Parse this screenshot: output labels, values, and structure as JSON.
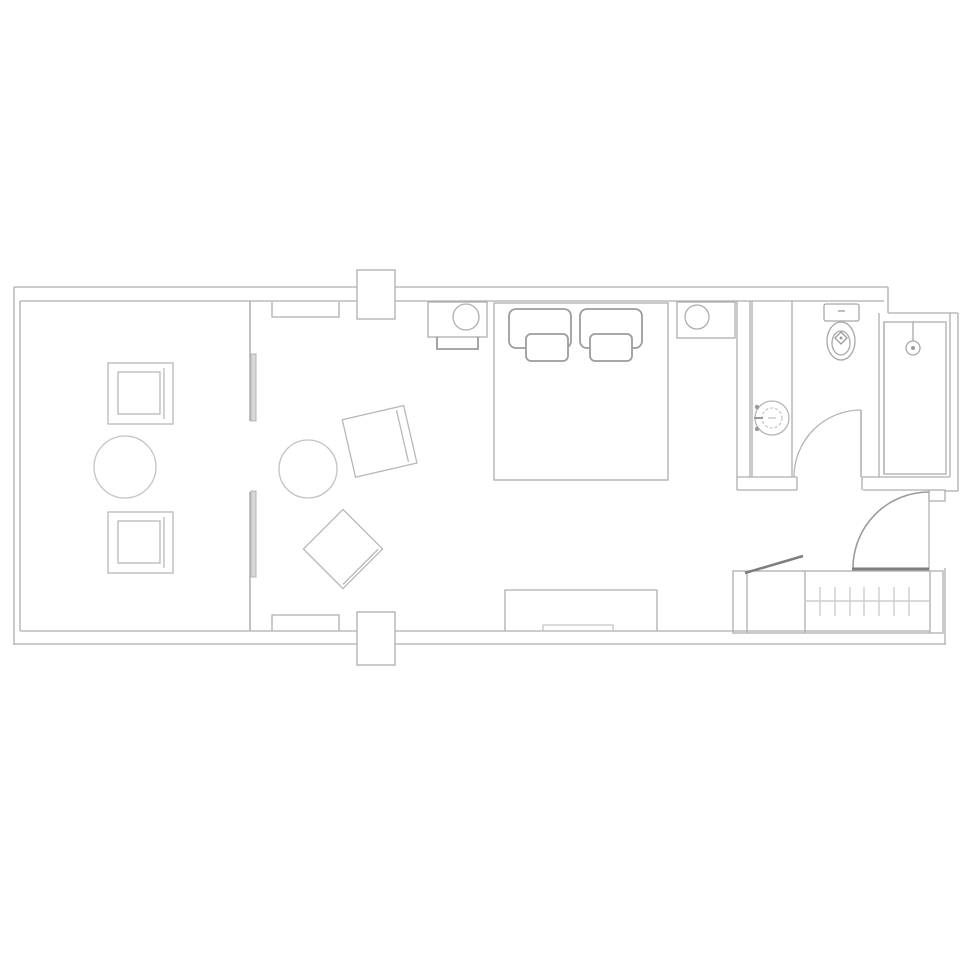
{
  "meta": {
    "title": "Hotel guest room floor plan",
    "description": "Monochrome line-drawing floor plan of a long guest room: balcony with two armchairs and round table, living area with armchair, ottoman and side table, bedroom with desk, king bed, nightstand and TV console, bathroom with vanity sink, toilet and shower, entry door and wardrobe with hangers and luggage rack."
  },
  "canvas": {
    "width": 975,
    "height": 975,
    "background": "#ffffff"
  },
  "palette": {
    "wall": "#aeaeae",
    "light": "#c3c3c3",
    "mid": "#9b9b9b",
    "dark": "#7e7e7e",
    "panel_fill": "#d8d8d8",
    "white": "#ffffff"
  },
  "rooms": [
    "balcony",
    "living-area",
    "bedroom",
    "bathroom",
    "entry",
    "wardrobe"
  ],
  "elements": [
    {
      "name": "outer-walls",
      "interactable": false,
      "shapes": [
        {
          "type": "line",
          "x1": 14,
          "y1": 287,
          "x2": 888,
          "y2": 287
        },
        {
          "type": "line",
          "x1": 20,
          "y1": 301,
          "x2": 884,
          "y2": 301
        },
        {
          "type": "line",
          "x1": 14,
          "y1": 287,
          "x2": 14,
          "y2": 645
        },
        {
          "type": "line",
          "x1": 20,
          "y1": 301,
          "x2": 20,
          "y2": 631
        },
        {
          "type": "line",
          "x1": 20,
          "y1": 631,
          "x2": 930,
          "y2": 631
        },
        {
          "type": "line",
          "x1": 14,
          "y1": 644,
          "x2": 946,
          "y2": 644
        },
        {
          "type": "line",
          "x1": 888,
          "y1": 287,
          "x2": 888,
          "y2": 313
        },
        {
          "type": "line",
          "x1": 888,
          "y1": 313,
          "x2": 958,
          "y2": 313
        },
        {
          "type": "line",
          "x1": 958,
          "y1": 313,
          "x2": 958,
          "y2": 491
        },
        {
          "type": "line",
          "x1": 958,
          "y1": 491,
          "x2": 945,
          "y2": 491
        },
        {
          "type": "rect",
          "x": 929,
          "y": 490,
          "w": 16,
          "h": 11
        },
        {
          "type": "line",
          "x1": 945,
          "y1": 568,
          "x2": 945,
          "y2": 644
        }
      ]
    },
    {
      "name": "balcony-divider-wall",
      "interactable": false,
      "sw": 1.5,
      "shapes": [
        {
          "type": "line",
          "x1": 250,
          "y1": 301,
          "x2": 250,
          "y2": 421
        },
        {
          "type": "line",
          "x1": 250,
          "y1": 492,
          "x2": 250,
          "y2": 631
        }
      ]
    },
    {
      "name": "sliding-door-panels",
      "interactable": false,
      "stroke": "#b5b5b5",
      "sw": 1,
      "shapes": [
        {
          "type": "rect",
          "x": 251,
          "y": 354,
          "w": 5,
          "h": 67,
          "fill": "#d8d8d8"
        },
        {
          "type": "rect",
          "x": 251,
          "y": 491,
          "w": 5,
          "h": 86,
          "fill": "#d8d8d8"
        }
      ]
    },
    {
      "name": "wall-pier-top",
      "interactable": false,
      "shapes": [
        {
          "type": "rect",
          "x": 357,
          "y": 270,
          "w": 38,
          "h": 49,
          "fill": "#ffffff"
        }
      ]
    },
    {
      "name": "wall-pier-bottom",
      "interactable": false,
      "shapes": [
        {
          "type": "rect",
          "x": 357,
          "y": 612,
          "w": 38,
          "h": 53,
          "fill": "#ffffff"
        }
      ]
    },
    {
      "name": "curtain-box-top",
      "interactable": false,
      "shapes": [
        {
          "type": "path",
          "d": "M272,302 L272,317 L339,317 L339,302"
        }
      ]
    },
    {
      "name": "curtain-box-bottom",
      "interactable": false,
      "shapes": [
        {
          "type": "path",
          "d": "M272,631 L272,615 L339,615 L339,631"
        }
      ]
    },
    {
      "name": "balcony-armchair-top",
      "interactable": false,
      "stroke": "#b8b8b8",
      "shapes": [
        {
          "type": "rect",
          "x": 108,
          "y": 363,
          "w": 65,
          "h": 61
        },
        {
          "type": "rect",
          "x": 118,
          "y": 372,
          "w": 42,
          "h": 42
        },
        {
          "type": "line",
          "x1": 164,
          "y1": 368,
          "x2": 164,
          "y2": 419
        }
      ]
    },
    {
      "name": "balcony-table",
      "interactable": false,
      "stroke": "#c3c3c3",
      "shapes": [
        {
          "type": "circle",
          "cx": 125,
          "cy": 467,
          "r": 31
        }
      ]
    },
    {
      "name": "balcony-armchair-bottom",
      "interactable": false,
      "stroke": "#b8b8b8",
      "shapes": [
        {
          "type": "rect",
          "x": 108,
          "y": 512,
          "w": 65,
          "h": 61
        },
        {
          "type": "rect",
          "x": 118,
          "y": 521,
          "w": 42,
          "h": 42
        },
        {
          "type": "line",
          "x1": 164,
          "y1": 517,
          "x2": 164,
          "y2": 568
        }
      ]
    },
    {
      "name": "living-side-table",
      "interactable": false,
      "stroke": "#c3c3c3",
      "shapes": [
        {
          "type": "circle",
          "cx": 308,
          "cy": 469,
          "r": 29
        }
      ]
    },
    {
      "name": "living-armchair",
      "interactable": false,
      "stroke": "#b8b8b8",
      "transform": "rotate(-13 379 441)",
      "shapes": [
        {
          "type": "rect",
          "x": 348,
          "y": 412,
          "w": 63,
          "h": 59
        },
        {
          "type": "line",
          "x1": 403,
          "y1": 415,
          "x2": 403,
          "y2": 468
        }
      ]
    },
    {
      "name": "living-ottoman",
      "interactable": false,
      "stroke": "#b8b8b8",
      "transform": "rotate(45 343 549)",
      "shapes": [
        {
          "type": "rect",
          "x": 315,
          "y": 521,
          "w": 56,
          "h": 56
        },
        {
          "type": "line",
          "x1": 368,
          "y1": 524,
          "x2": 368,
          "y2": 574
        }
      ]
    },
    {
      "name": "desk",
      "interactable": false,
      "shapes": [
        {
          "type": "rect",
          "x": 428,
          "y": 302,
          "w": 59,
          "h": 35
        }
      ]
    },
    {
      "name": "desk-stool",
      "interactable": false,
      "shapes": [
        {
          "type": "circle",
          "cx": 466,
          "cy": 317,
          "r": 13
        }
      ]
    },
    {
      "name": "desk-chair",
      "interactable": false,
      "stroke": "#9b9b9b",
      "sw": 1.8,
      "shapes": [
        {
          "type": "path",
          "d": "M437,337 L437,349 L478,349 L478,337"
        }
      ]
    },
    {
      "name": "bed",
      "interactable": false,
      "shapes": [
        {
          "type": "rect",
          "x": 494,
          "y": 303,
          "w": 174,
          "h": 177
        }
      ]
    },
    {
      "name": "bed-pillows",
      "interactable": false,
      "stroke": "#9c9c9c",
      "sw": 1.8,
      "shapes": [
        {
          "type": "rect",
          "x": 509,
          "y": 309,
          "w": 62,
          "h": 39,
          "rx": 7,
          "fill": "#ffffff"
        },
        {
          "type": "rect",
          "x": 580,
          "y": 309,
          "w": 62,
          "h": 39,
          "rx": 7,
          "fill": "#ffffff"
        },
        {
          "type": "rect",
          "x": 526,
          "y": 334,
          "w": 42,
          "h": 27,
          "rx": 5,
          "fill": "#ffffff"
        },
        {
          "type": "rect",
          "x": 590,
          "y": 334,
          "w": 42,
          "h": 27,
          "rx": 5,
          "fill": "#ffffff"
        }
      ]
    },
    {
      "name": "nightstand",
      "interactable": false,
      "shapes": [
        {
          "type": "rect",
          "x": 677,
          "y": 302,
          "w": 58,
          "h": 36
        }
      ]
    },
    {
      "name": "table-lamp",
      "interactable": false,
      "shapes": [
        {
          "type": "circle",
          "cx": 697,
          "cy": 317,
          "r": 12
        }
      ]
    },
    {
      "name": "tv-console",
      "interactable": false,
      "shapes": [
        {
          "type": "path",
          "d": "M505,631 L505,590 L657,590 L657,631"
        },
        {
          "type": "path",
          "d": "M543,631 L543,625 L613,625 L613,631",
          "stroke": "#c3c3c3"
        }
      ]
    },
    {
      "name": "bedroom-bathroom-wall",
      "interactable": false,
      "shapes": [
        {
          "type": "line",
          "x1": 737,
          "y1": 301,
          "x2": 737,
          "y2": 490
        },
        {
          "type": "line",
          "x1": 750,
          "y1": 301,
          "x2": 750,
          "y2": 477
        }
      ]
    },
    {
      "name": "bathroom-lower-wall",
      "interactable": false,
      "shapes": [
        {
          "type": "line",
          "x1": 737,
          "y1": 477,
          "x2": 797,
          "y2": 477
        },
        {
          "type": "line",
          "x1": 797,
          "y1": 477,
          "x2": 797,
          "y2": 490
        },
        {
          "type": "line",
          "x1": 737,
          "y1": 490,
          "x2": 797,
          "y2": 490
        },
        {
          "type": "line",
          "x1": 862,
          "y1": 477,
          "x2": 950,
          "y2": 477
        },
        {
          "type": "line",
          "x1": 862,
          "y1": 477,
          "x2": 862,
          "y2": 490
        },
        {
          "type": "line",
          "x1": 863,
          "y1": 490,
          "x2": 929,
          "y2": 490
        }
      ]
    },
    {
      "name": "vanity-counter",
      "interactable": false,
      "shapes": [
        {
          "type": "line",
          "x1": 752,
          "y1": 301,
          "x2": 752,
          "y2": 477
        },
        {
          "type": "line",
          "x1": 792,
          "y1": 301,
          "x2": 792,
          "y2": 477
        }
      ]
    },
    {
      "name": "vanity-sink",
      "interactable": false,
      "stroke": "#b5b5b5",
      "shapes": [
        {
          "type": "circle",
          "cx": 772,
          "cy": 418,
          "r": 17
        },
        {
          "type": "circle",
          "cx": 772,
          "cy": 418,
          "r": 10,
          "stroke": "#c6c6c6",
          "dash": "3,2"
        },
        {
          "type": "line",
          "x1": 768,
          "y1": 418,
          "x2": 776,
          "y2": 418,
          "stroke": "#c6c6c6"
        }
      ]
    },
    {
      "name": "sink-faucet",
      "interactable": false,
      "shapes": [
        {
          "type": "circle",
          "cx": 757,
          "cy": 407,
          "r": 2.2,
          "fill": "#9b9b9b",
          "stroke": "none"
        },
        {
          "type": "circle",
          "cx": 757,
          "cy": 429,
          "r": 2.2,
          "fill": "#9b9b9b",
          "stroke": "none"
        },
        {
          "type": "line",
          "x1": 754,
          "y1": 418,
          "x2": 763,
          "y2": 418,
          "stroke": "#9b9b9b",
          "sw": 2
        }
      ]
    },
    {
      "name": "toilet",
      "interactable": false,
      "stroke": "#a8a8a8",
      "shapes": [
        {
          "type": "rect",
          "x": 824,
          "y": 304,
          "w": 35,
          "h": 17,
          "rx": 2,
          "fill": "#ffffff"
        },
        {
          "type": "line",
          "x1": 838,
          "y1": 311,
          "x2": 845,
          "y2": 311,
          "stroke": "#9b9b9b"
        },
        {
          "type": "ellipse",
          "cx": 841,
          "cy": 341,
          "rx": 14,
          "ry": 19,
          "fill": "#ffffff"
        },
        {
          "type": "ellipse",
          "cx": 841,
          "cy": 343,
          "rx": 9,
          "ry": 12
        },
        {
          "type": "path",
          "d": "M841,332 L847,338 L841,344 L835,338 Z",
          "stroke": "#9b9b9b"
        },
        {
          "type": "circle",
          "cx": 841,
          "cy": 338,
          "r": 1.5,
          "fill": "#9b9b9b",
          "stroke": "none"
        }
      ]
    },
    {
      "name": "toilet-shower-wall",
      "interactable": false,
      "shapes": [
        {
          "type": "line",
          "x1": 879,
          "y1": 313,
          "x2": 879,
          "y2": 477
        },
        {
          "type": "line",
          "x1": 884,
          "y1": 322,
          "x2": 884,
          "y2": 474
        }
      ]
    },
    {
      "name": "shower-enclosure",
      "interactable": false,
      "shapes": [
        {
          "type": "rect",
          "x": 884,
          "y": 322,
          "w": 62,
          "h": 152
        },
        {
          "type": "line",
          "x1": 950,
          "y1": 313,
          "x2": 950,
          "y2": 477
        }
      ]
    },
    {
      "name": "shower-head",
      "interactable": false,
      "stroke": "#a8a8a8",
      "shapes": [
        {
          "type": "line",
          "x1": 913,
          "y1": 322,
          "x2": 913,
          "y2": 341
        },
        {
          "type": "circle",
          "cx": 913,
          "cy": 348,
          "r": 7
        },
        {
          "type": "circle",
          "cx": 913,
          "cy": 348,
          "r": 2,
          "fill": "#9b9b9b",
          "stroke": "none"
        }
      ]
    },
    {
      "name": "bathroom-door",
      "interactable": false,
      "shapes": [
        {
          "type": "line",
          "x1": 861,
          "y1": 410,
          "x2": 861,
          "y2": 477,
          "sw": 1.5
        },
        {
          "type": "path",
          "d": "M861,410 A67,67 0 0 0 794,477",
          "stroke": "#b4b4b4"
        }
      ]
    },
    {
      "name": "entry-door",
      "interactable": false,
      "shapes": [
        {
          "type": "path",
          "d": "M853,568 A76,76 0 0 1 929,492",
          "stroke": "#9b9b9b",
          "sw": 1.6
        },
        {
          "type": "line",
          "x1": 929,
          "y1": 492,
          "x2": 929,
          "y2": 570,
          "sw": 1.2
        },
        {
          "type": "line",
          "x1": 852,
          "y1": 569,
          "x2": 929,
          "y2": 569,
          "stroke": "#7e7e7e",
          "sw": 3
        }
      ]
    },
    {
      "name": "wardrobe",
      "interactable": false,
      "shapes": [
        {
          "type": "rect",
          "x": 733,
          "y": 571,
          "w": 210,
          "h": 62
        },
        {
          "type": "line",
          "x1": 747,
          "y1": 571,
          "x2": 747,
          "y2": 633
        },
        {
          "type": "line",
          "x1": 805,
          "y1": 571,
          "x2": 805,
          "y2": 633
        },
        {
          "type": "line",
          "x1": 930,
          "y1": 571,
          "x2": 930,
          "y2": 633
        },
        {
          "type": "line",
          "x1": 806,
          "y1": 601,
          "x2": 929,
          "y2": 601,
          "stroke": "#c3c3c3"
        }
      ]
    },
    {
      "name": "wardrobe-hangers",
      "interactable": false,
      "stroke": "#cccccc",
      "sw": 1.4,
      "shapes": [
        {
          "type": "line",
          "x1": 820,
          "y1": 587,
          "x2": 820,
          "y2": 616
        },
        {
          "type": "line",
          "x1": 835,
          "y1": 587,
          "x2": 835,
          "y2": 616
        },
        {
          "type": "line",
          "x1": 850,
          "y1": 587,
          "x2": 850,
          "y2": 616
        },
        {
          "type": "line",
          "x1": 864,
          "y1": 587,
          "x2": 864,
          "y2": 616
        },
        {
          "type": "line",
          "x1": 879,
          "y1": 587,
          "x2": 879,
          "y2": 616
        },
        {
          "type": "line",
          "x1": 894,
          "y1": 587,
          "x2": 894,
          "y2": 616
        },
        {
          "type": "line",
          "x1": 909,
          "y1": 587,
          "x2": 909,
          "y2": 616
        }
      ]
    },
    {
      "name": "luggage-rack",
      "interactable": false,
      "shapes": [
        {
          "type": "line",
          "x1": 745,
          "y1": 573,
          "x2": 803,
          "y2": 556,
          "stroke": "#7e7e7e",
          "sw": 2.5
        }
      ]
    }
  ]
}
